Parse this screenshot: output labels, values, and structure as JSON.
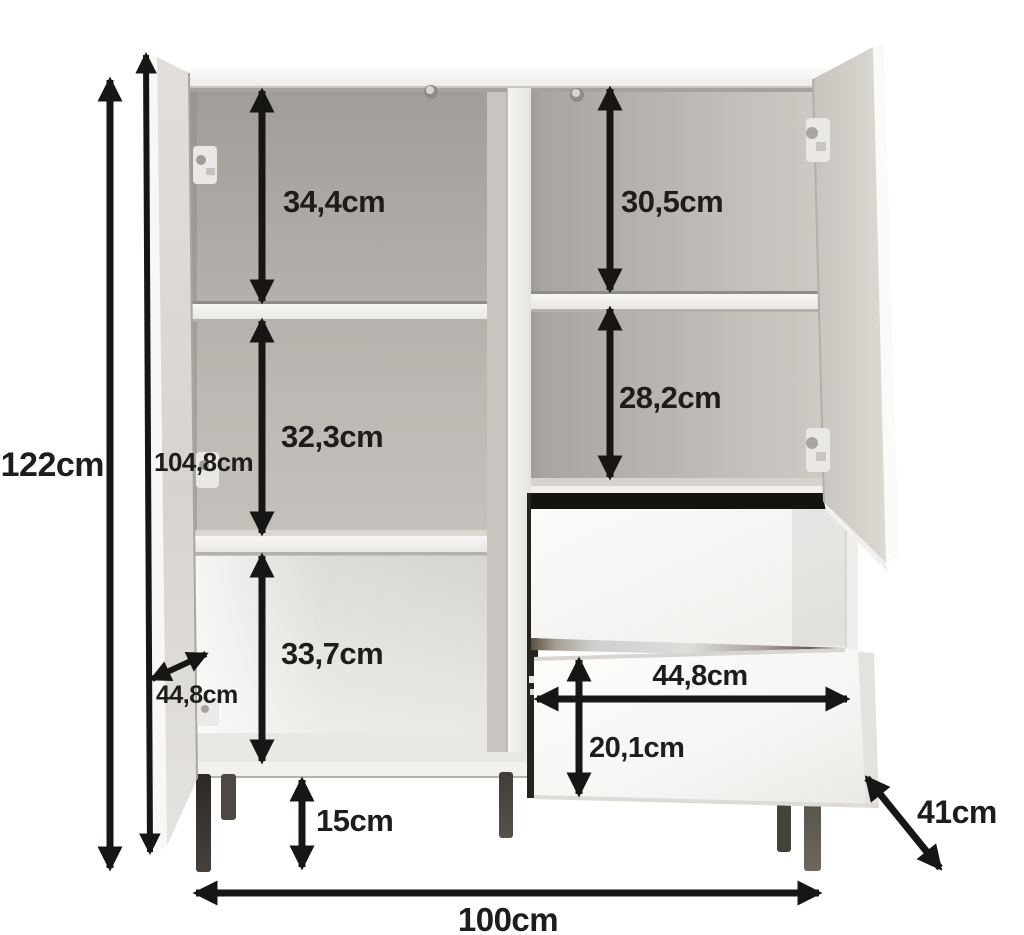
{
  "diagram": {
    "unit": "cm",
    "colors": {
      "background": "#ffffff",
      "annotation": "#181614",
      "interior_gray": "#bcb9b3",
      "panel_white": "#f3f2ef",
      "leg_dark": "#3a3632"
    },
    "dims": {
      "total_height": "122cm",
      "door_height": "104,8cm",
      "left_top_compartment": "34,4cm",
      "left_middle_compartment": "32,3cm",
      "left_bottom_compartment": "33,7cm",
      "right_top_compartment": "30,5cm",
      "right_second_compartment": "28,2cm",
      "door_width": "44,8cm",
      "drawer_width": "44,8cm",
      "drawer_height": "20,1cm",
      "leg_height": "15cm",
      "depth": "41cm",
      "total_width": "100cm"
    }
  }
}
